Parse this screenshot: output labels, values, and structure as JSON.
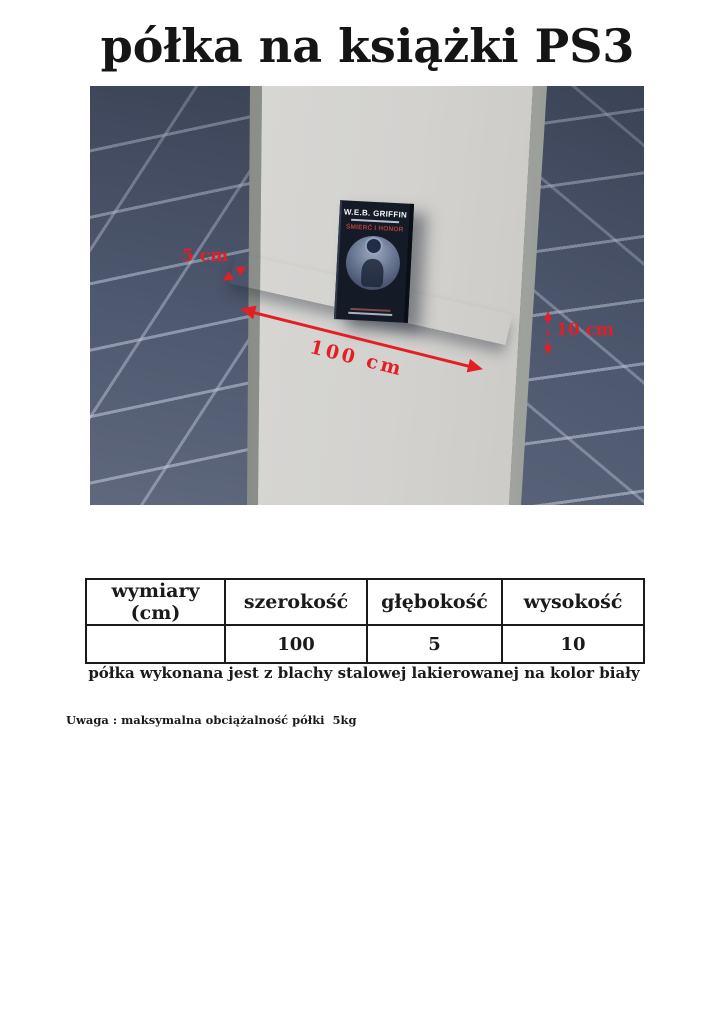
{
  "page": {
    "title": "półka na książki PS3",
    "caption": "półka wykonana jest z blachy stalowej lakierowanej na kolor biały",
    "note": "Uwaga : maksymalna obciążalność półki  5kg"
  },
  "figure": {
    "description": "3D render of white steel book shelf mounted on a light grey column against dark blue-grey tiled walls",
    "annotations": {
      "depth": "5 cm",
      "width": "100 cm",
      "height": "10 cm"
    },
    "book": {
      "author": "W.E.B. GRIFFIN",
      "title": "ŚMIERĆ I HONOR"
    },
    "colors": {
      "annotation_red": "#e41e26",
      "tile_wall": "#4d576d",
      "column": "#d3d2cf",
      "shelf": "#ffffff",
      "book_cover": "#141a26"
    }
  },
  "table": {
    "headers": [
      "wymiary (cm)",
      "szerokość",
      "głębokość",
      "wysokość"
    ],
    "rows": [
      [
        "",
        "100",
        "5",
        "10"
      ]
    ]
  }
}
